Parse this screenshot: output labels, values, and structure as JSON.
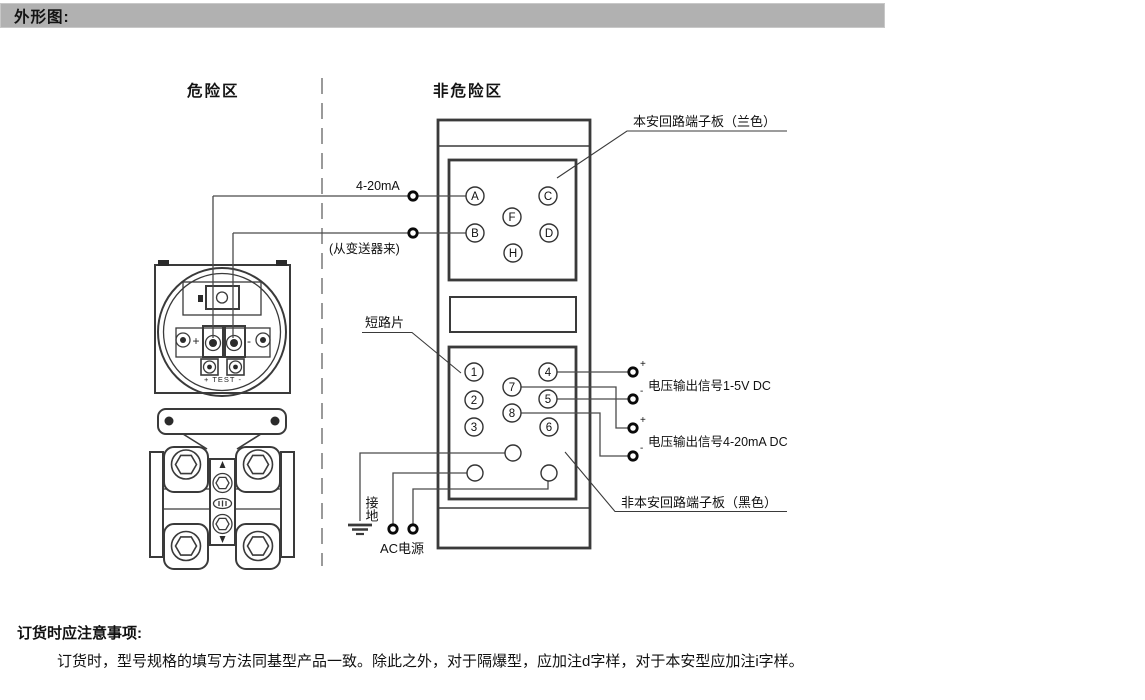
{
  "header": {
    "title": "外形图:"
  },
  "zones": {
    "hazardous": "危险区",
    "non_hazardous": "非危险区"
  },
  "board": {
    "is_label": "本安回路端子板（兰色）",
    "non_is_label": "非本安回路端子板（黑色）",
    "short_bar_label": "短路片",
    "terminals_is": [
      "A",
      "C",
      "F",
      "B",
      "D",
      "H"
    ],
    "terminals_non_is": [
      "1",
      "4",
      "7",
      "2",
      "5",
      "8",
      "3",
      "6"
    ]
  },
  "wiring": {
    "current_loop_label": "4-20mA",
    "from_transmitter_label": "(从变送器来)",
    "voltage_out_1_5v_label": "电压输出信号1-5V DC",
    "voltage_out_4_20ma_label": "电压输出信号4-20mA DC",
    "ground_label": "接地",
    "ac_power_label": "AC电源",
    "polarity": [
      "+",
      "-",
      "+",
      "-"
    ]
  },
  "transmitter": {
    "plus_label": "+",
    "minus_label": "-",
    "test_label": "+ TEST -"
  },
  "notes": {
    "heading": "订货时应注意事项:",
    "body": "订货时，型号规格的填写方法同基型产品一致。除此之外，对于隔爆型，应加注d字样，对于本安型应加注i字样。"
  }
}
